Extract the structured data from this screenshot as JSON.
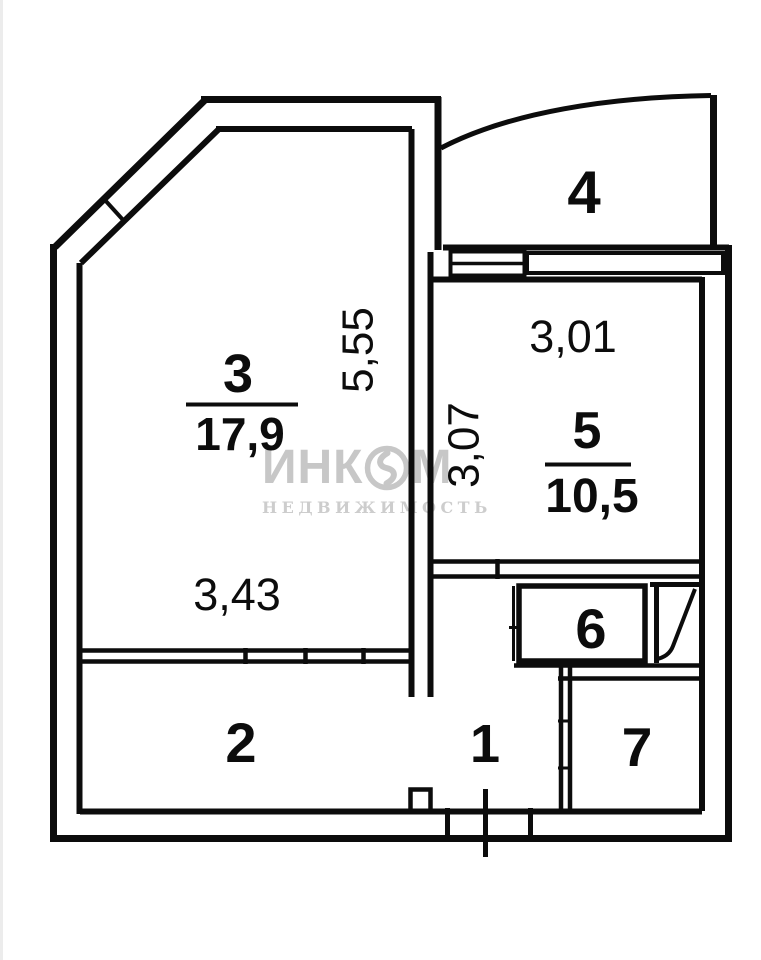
{
  "watermark": {
    "brand_prefix": "ИНК",
    "brand_suffix": "М",
    "subtitle": "НЕДВИЖИМОСТЬ"
  },
  "rooms": {
    "room1": {
      "number": "1"
    },
    "room2": {
      "number": "2"
    },
    "room3": {
      "number": "3",
      "area": "17,9"
    },
    "room4": {
      "number": "4"
    },
    "room5": {
      "number": "5",
      "area": "10,5"
    },
    "room6": {
      "number": "6"
    },
    "room7": {
      "number": "7"
    }
  },
  "dimensions": {
    "room3_width": "3,43",
    "room3_height": "5,55",
    "room5_width": "3,01",
    "room5_height": "3,07"
  },
  "colors": {
    "wall_line": "#0c0c0c",
    "watermark_gray": "#c7c7c7",
    "background": "#ffffff"
  }
}
